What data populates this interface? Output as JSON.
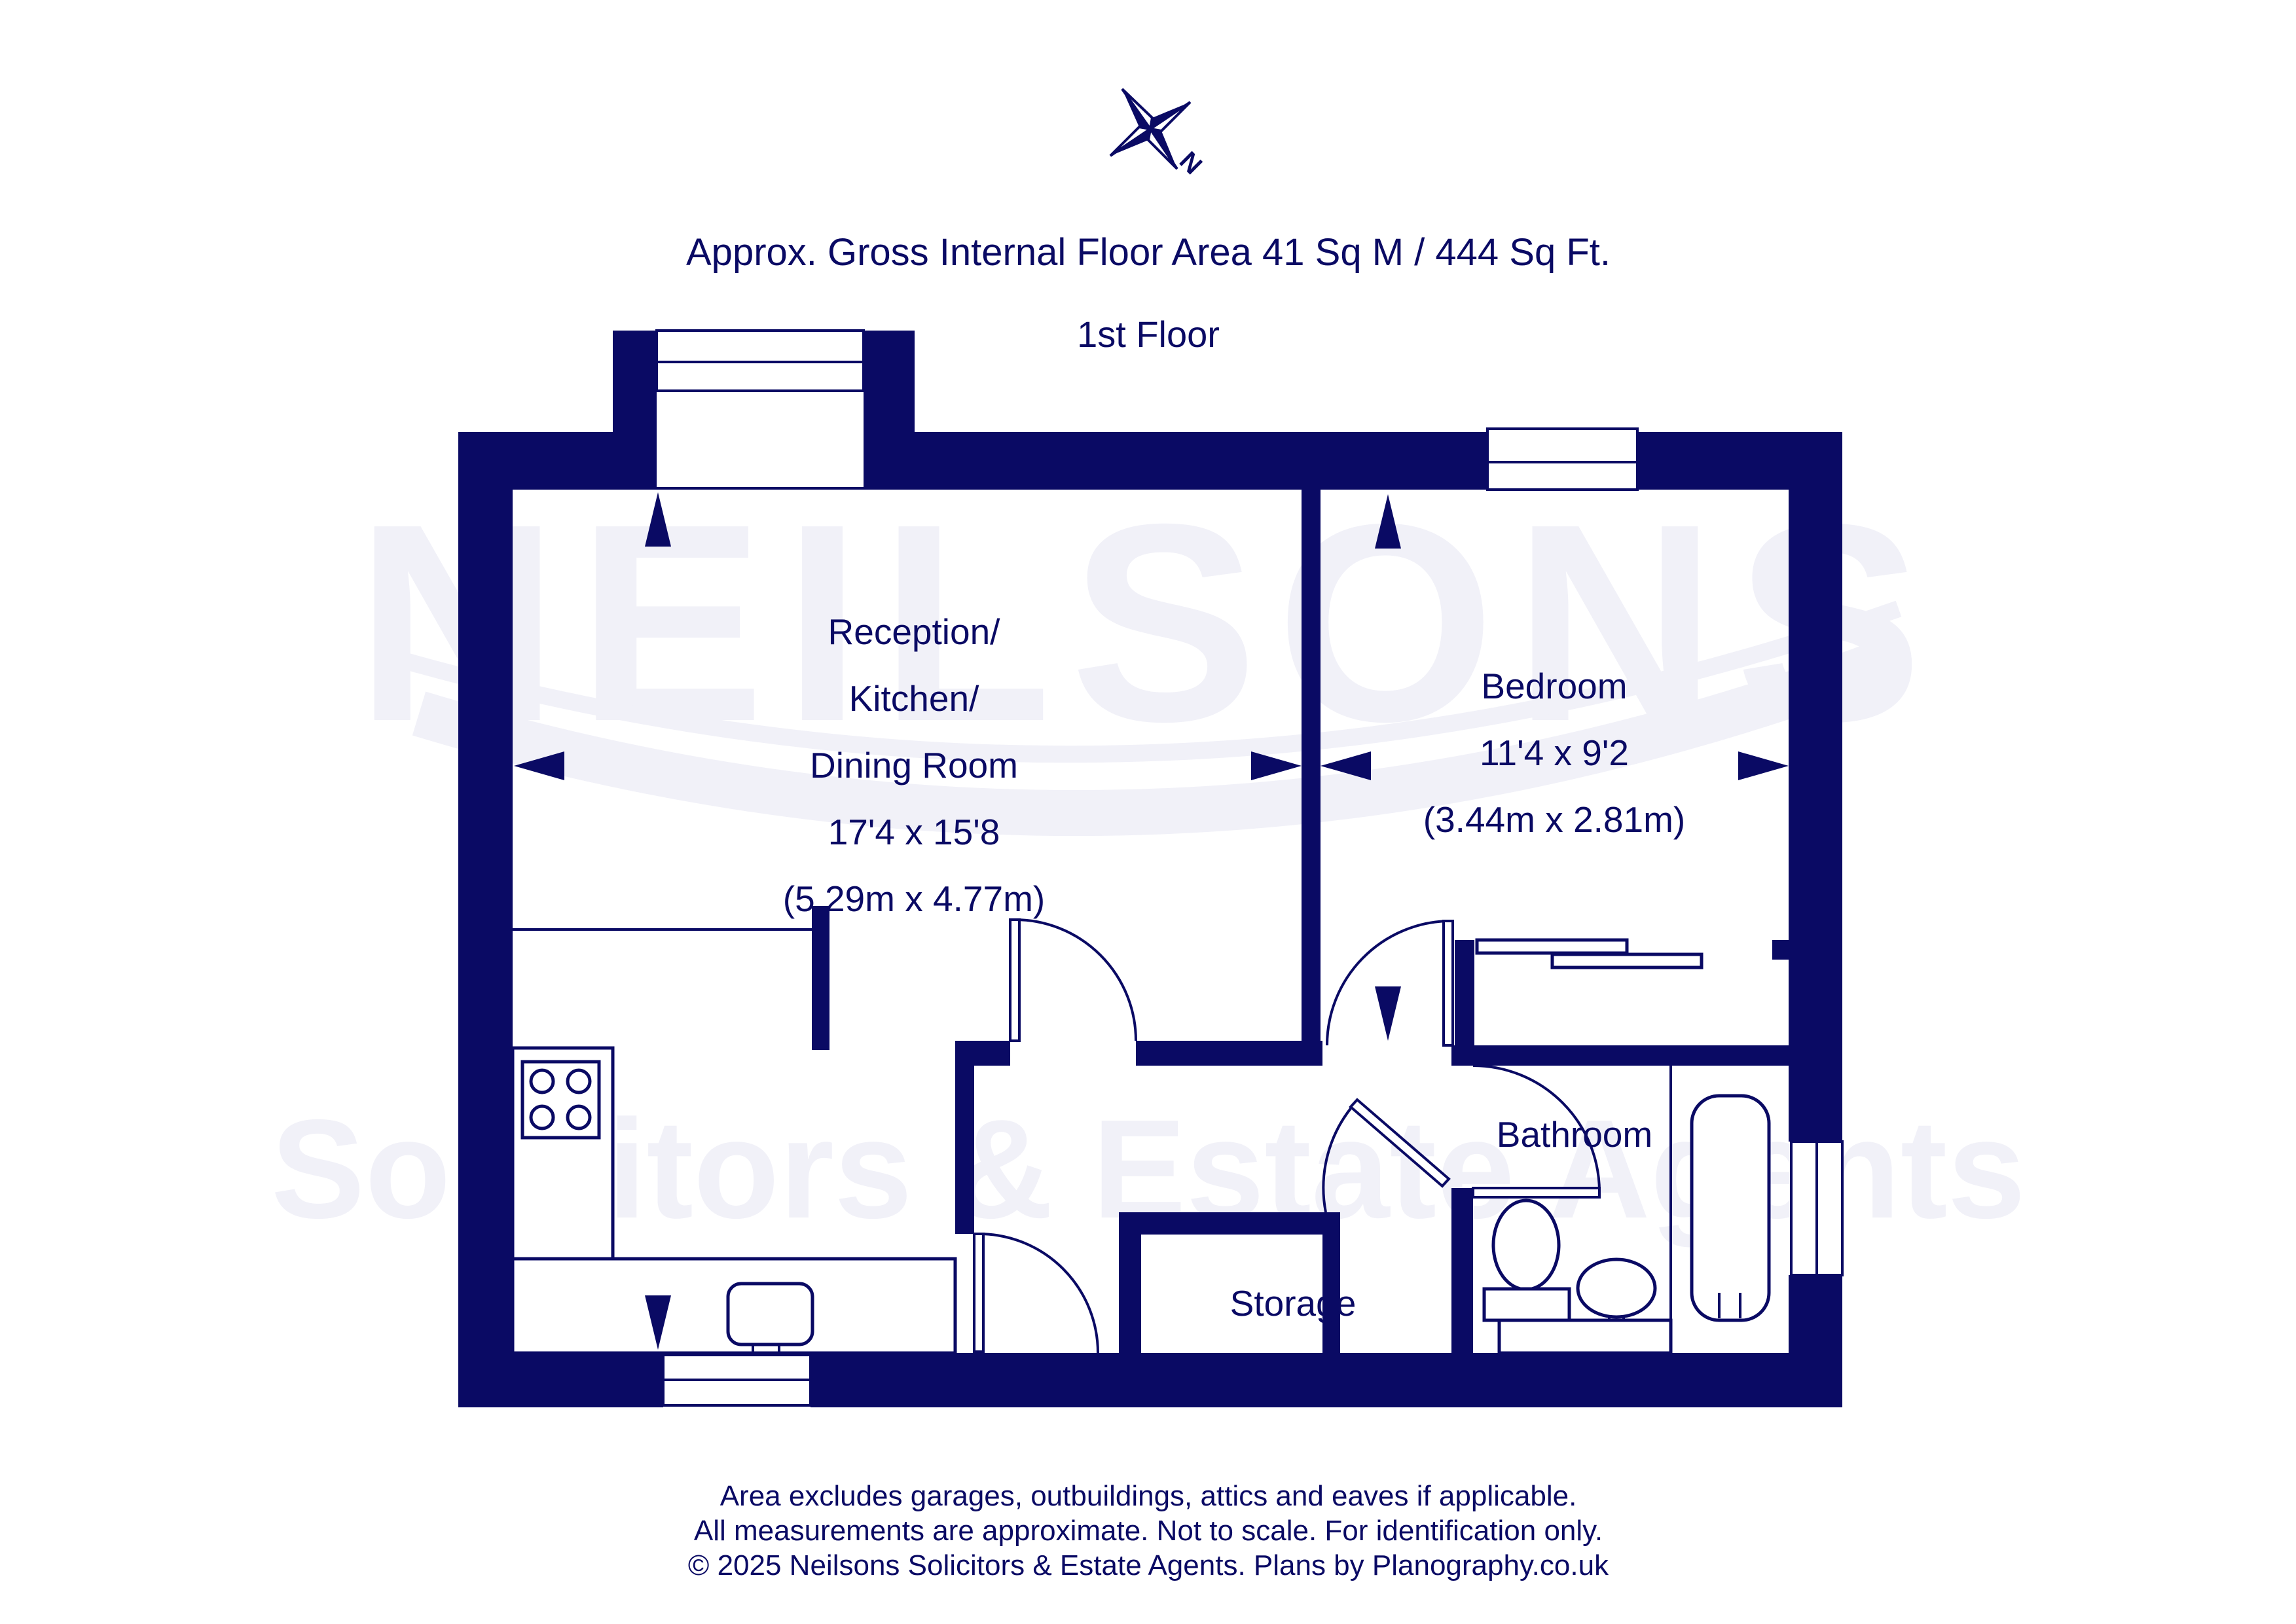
{
  "colors": {
    "navy": "#0A0A64",
    "watermark": "#F1F1F8",
    "background": "#FFFFFF"
  },
  "header": {
    "title": "Approx. Gross Internal Floor Area 41 Sq M / 444 Sq Ft.",
    "floor_label": "1st Floor"
  },
  "compass": {
    "north_label": "N"
  },
  "watermark": {
    "line1": "NEILSONS",
    "line2": "Solicitors & Estate Agents"
  },
  "rooms": {
    "reception": {
      "name_lines": [
        "Reception/",
        "Kitchen/",
        "Dining Room"
      ],
      "dims_imperial": "17'4 x 15'8",
      "dims_metric": "(5.29m x 4.77m)"
    },
    "bedroom": {
      "name": "Bedroom",
      "dims_imperial": "11'4 x 9'2",
      "dims_metric": "(3.44m x 2.81m)"
    },
    "bathroom": {
      "name": "Bathroom"
    },
    "storage": {
      "name": "Storage"
    }
  },
  "footer": {
    "lines": [
      "Area excludes garages, outbuildings, attics and eaves if applicable.",
      "All measurements are approximate. Not to scale. For identification only.",
      "© 2025 Neilsons Solicitors & Estate Agents. Plans by Planography.co.uk"
    ]
  }
}
